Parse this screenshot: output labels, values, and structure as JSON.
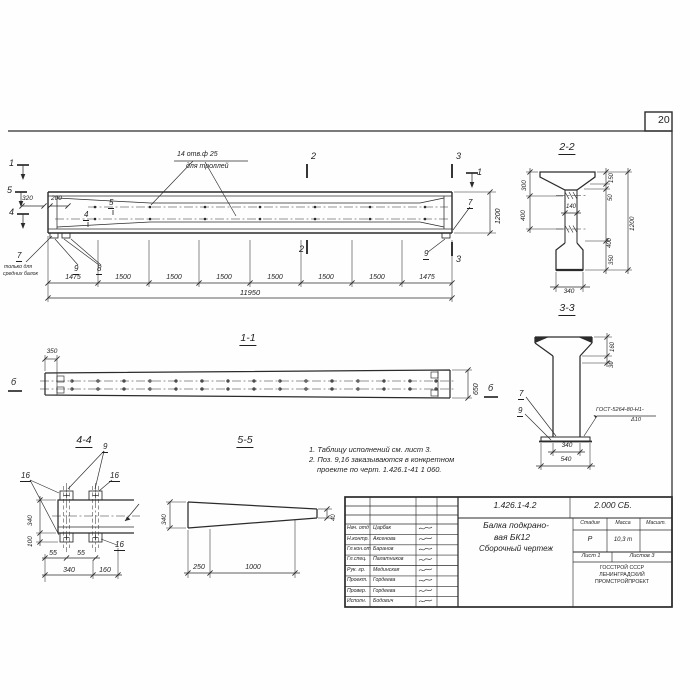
{
  "sheet": {
    "page_number": "20"
  },
  "main_view": {
    "holes_note_line1": "14 отв.ф 25",
    "holes_note_line2": "для троллей",
    "marker_1": "1",
    "marker_5": "5",
    "marker_4": "4",
    "marker_2": "2",
    "marker_3": "3",
    "marker_1_right": "1",
    "dim_320": "320",
    "dim_200": "200",
    "pos_5": "5",
    "pos_4": "4",
    "pos_7": "7",
    "note_7_line1": "только для",
    "note_7_line2": "средних балок",
    "pos_9_left": "9",
    "pos_8": "8",
    "pos_9_right": "9",
    "pos_7_right": "7",
    "dim_1200": "1200",
    "chain": [
      "1475",
      "1500",
      "1500",
      "1500",
      "1500",
      "1500",
      "1500",
      "1475"
    ],
    "dim_total": "11950"
  },
  "section_1_1": {
    "label": "1-1",
    "dim_350": "350",
    "dim_650": "650",
    "marker_left": "б",
    "marker_right": "б"
  },
  "section_4_4": {
    "label": "4-4",
    "pos_9": "9",
    "pos_16_a": "16",
    "pos_16_b": "16",
    "pos_16_c": "16",
    "dim_340_left": "340",
    "dim_100": "100",
    "dim_55_a": "55",
    "dim_55_b": "55",
    "dim_340_bottom": "340",
    "dim_160": "160"
  },
  "section_5_5": {
    "label": "5-5",
    "dim_340": "340",
    "dim_250": "250",
    "dim_1000": "1000",
    "dim_40": "40"
  },
  "notes": {
    "line1": "1. Таблицу исполнений см. лист 3.",
    "line2": "2. Поз. 9,16 заказываются в конкретном",
    "line3": "проекте по черт. 1.426.1-41 1 060."
  },
  "section_2_2": {
    "label": "2-2",
    "dim_300": "300",
    "dim_400_left": "400",
    "dim_150": "150",
    "dim_50": "50",
    "dim_1200": "1200",
    "dim_400_right": "400",
    "dim_350": "350",
    "dim_140": "140",
    "dim_340": "340"
  },
  "section_3_3": {
    "label": "3-3",
    "dim_160": "160",
    "dim_30": "30",
    "pos_7": "7",
    "pos_9": "9",
    "weld_note_line1": "ГОСТ-5264-80-Н1-",
    "weld_note_line2": "Δ10",
    "dim_340": "340",
    "dim_540": "540"
  },
  "title_block": {
    "doc_number": "1.426.1-4.2",
    "doc_code": "2.000 СБ.",
    "title_line1": "Балка подкрано-",
    "title_line2": "вая БК12",
    "title_line3": "Сборочный чертеж",
    "col_stage": "Стадия",
    "col_mass": "Масса",
    "col_scale": "Масшт.",
    "stage_value": "Р",
    "mass_value": "10,3 т",
    "sheet_label": "Лист 1",
    "sheets_label": "Листов 3",
    "org_line1": "ГОССТРОЙ СССР",
    "org_line2": "ЛЕНИНГРАДСКИЙ",
    "org_line3": "ПРОМСТРОЙПРОЕКТ",
    "signatures": [
      {
        "role": "Нач. отд",
        "name": "Царбак"
      },
      {
        "role": "Н.контр.",
        "name": "Аксенова"
      },
      {
        "role": "Гл.кон.от",
        "name": "Баранов"
      },
      {
        "role": "Гл.спец.",
        "name": "Палатников"
      },
      {
        "role": "Рук. гр.",
        "name": "Мединская"
      },
      {
        "role": "Проект.",
        "name": "Гордеева"
      },
      {
        "role": "Провер.",
        "name": "Гордеева"
      },
      {
        "role": "Исполн.",
        "name": "Бодович"
      }
    ]
  }
}
